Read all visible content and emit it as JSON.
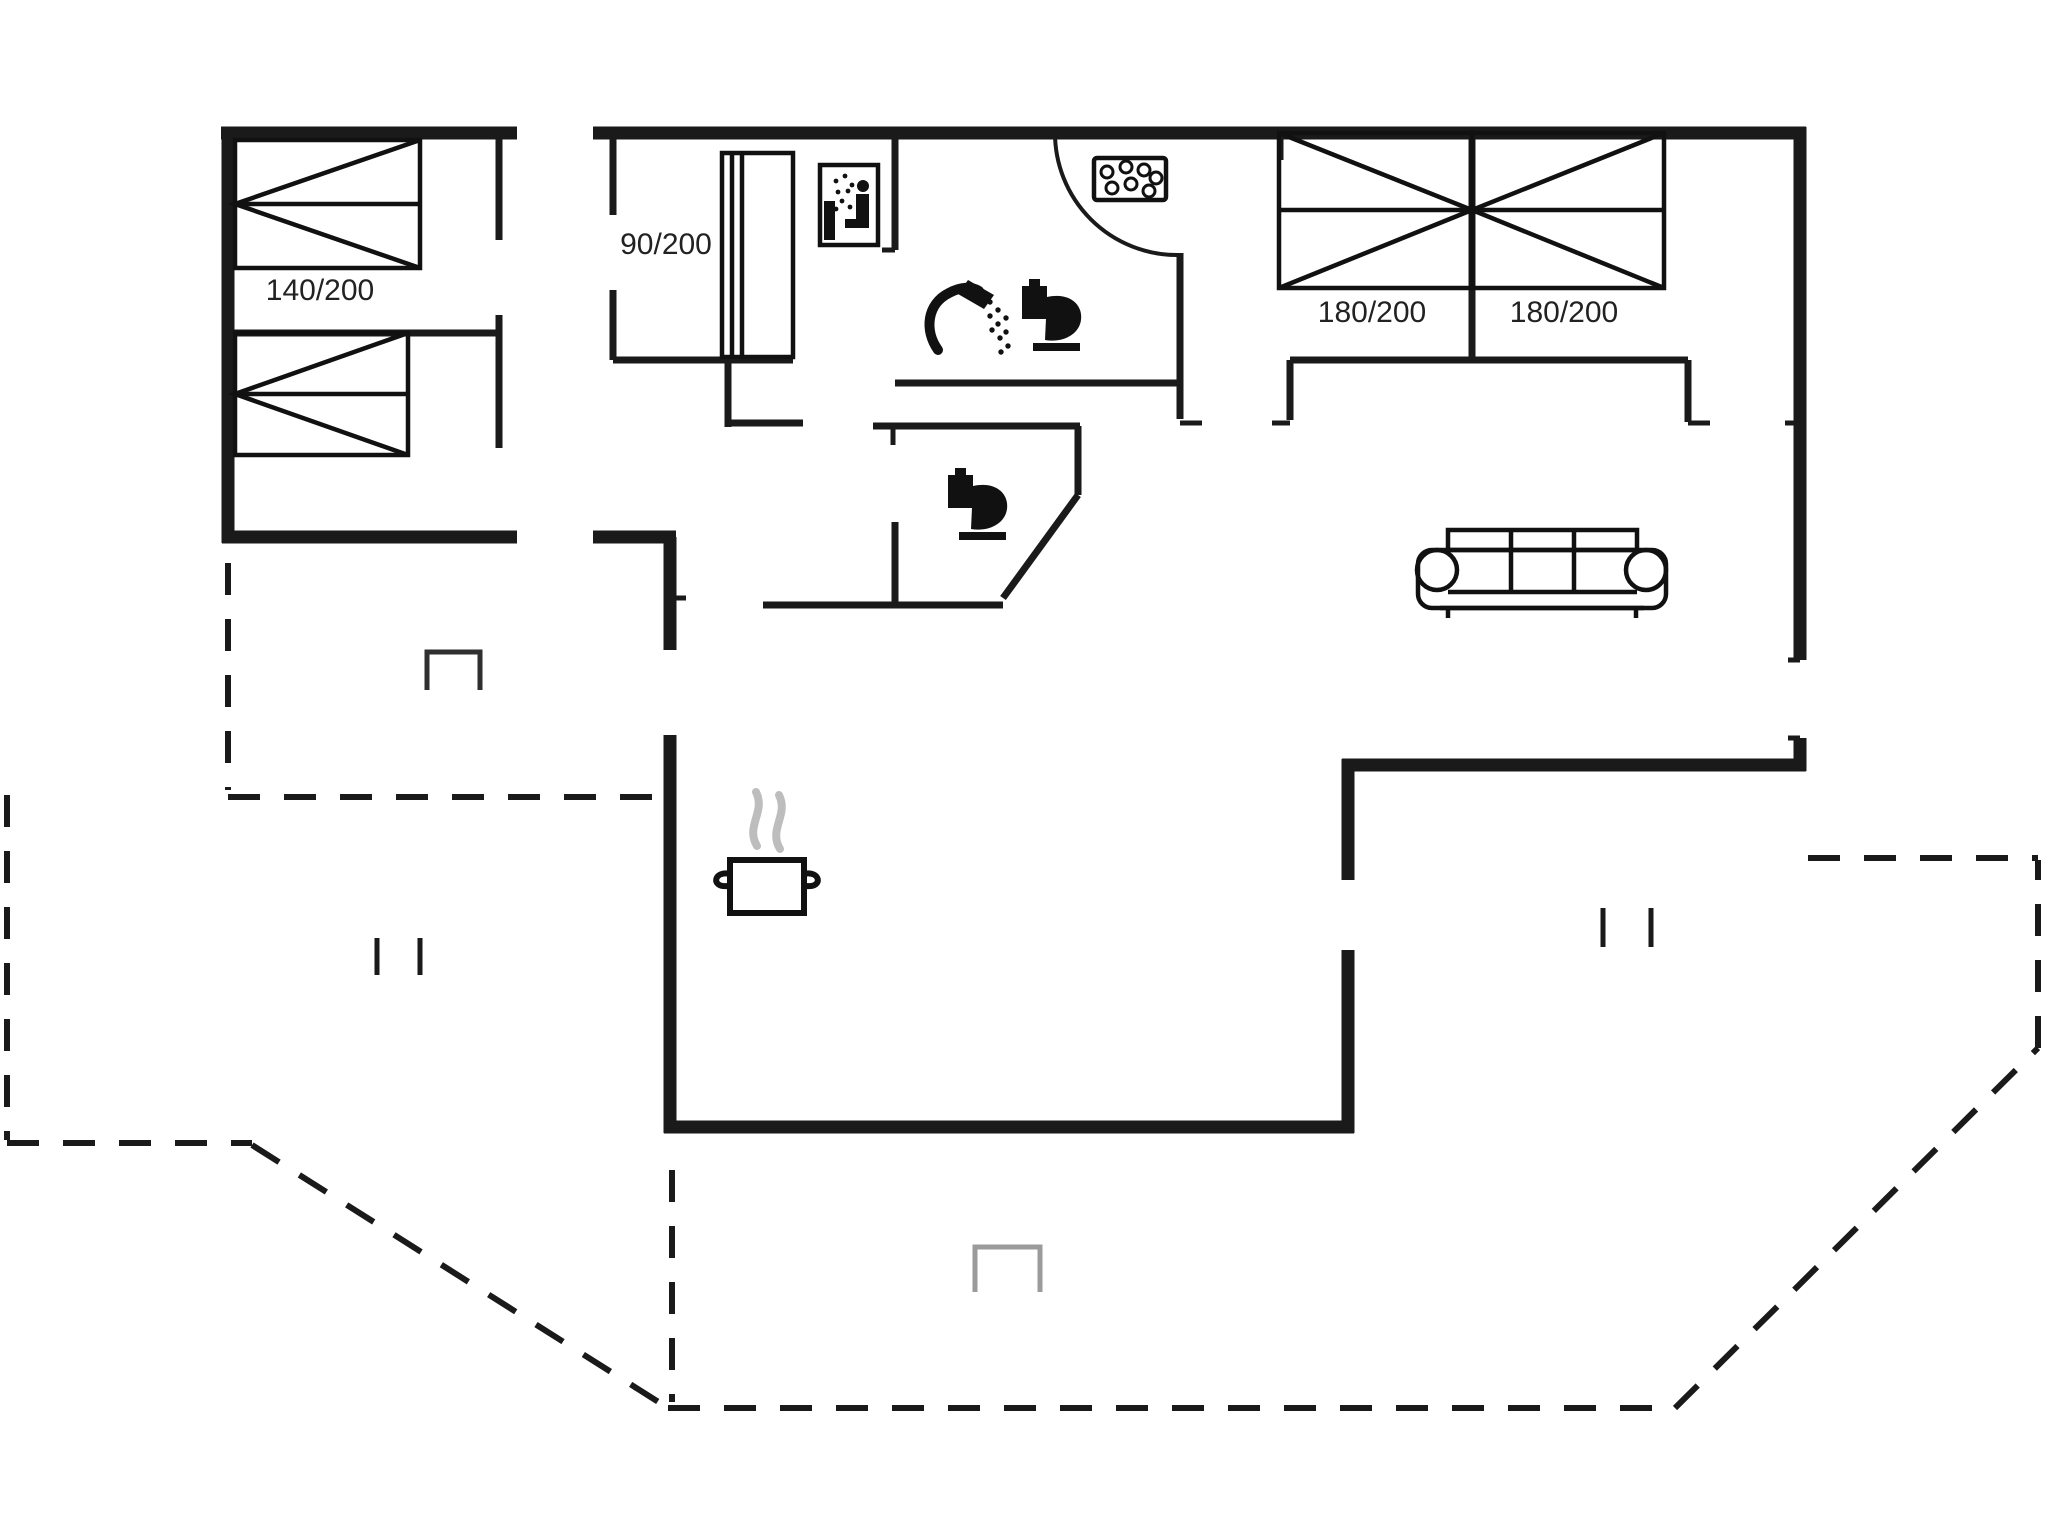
{
  "page": {
    "title": "Holiday house floor plan",
    "background": "#ffffff"
  },
  "colors": {
    "wall": "#1a1a1a",
    "furniture": "#111111",
    "steam": "#bdbdbd",
    "marker_dark": "#2f2f2f",
    "marker_gray": "#9b9b9b",
    "text": "#222222",
    "background": "#ffffff"
  },
  "floor_plan": {
    "labels": {
      "bed_large_left": "140/200",
      "bed_single": "90/200",
      "bed_double_1": "180/200",
      "bed_double_2": "180/200"
    },
    "icons": [
      "double-bed-140x200-icon",
      "single-bed-icon",
      "bed-90x200-icon",
      "double-bed-180x200-left-icon",
      "double-bed-180x200-right-icon",
      "sauna-icon",
      "whirlpool-icon",
      "shower-icon",
      "toilet-icon",
      "toilet-icon",
      "cooking-pot-icon",
      "steam-icon",
      "sofa-icon",
      "door-swing-arc",
      "terrace-dashed-outline",
      "window-marker",
      "terrace-marker"
    ]
  }
}
